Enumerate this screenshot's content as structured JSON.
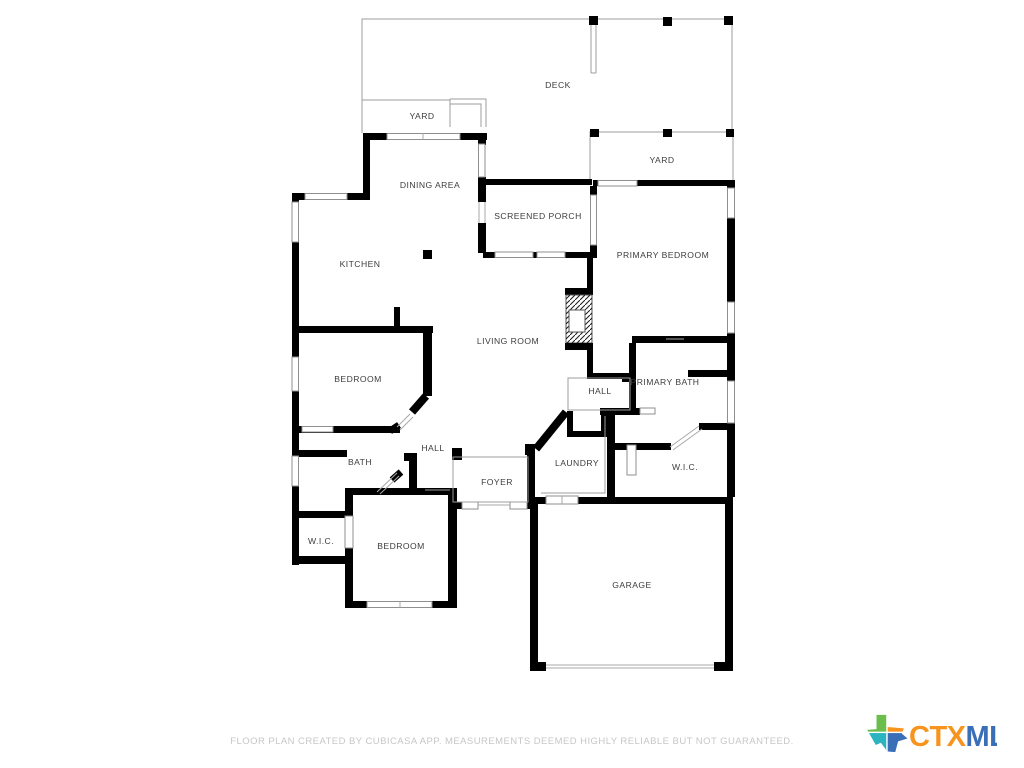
{
  "floor_plan": {
    "rooms": {
      "deck": "DECK",
      "yard_upper": "YARD",
      "yard_lower": "YARD",
      "dining_area": "DINING AREA",
      "screened_porch": "SCREENED PORCH",
      "kitchen": "KITCHEN",
      "primary_bedroom": "PRIMARY BEDROOM",
      "living_room": "LIVING ROOM",
      "hall_upper": "HALL",
      "primary_bath": "PRIMARY BATH",
      "bedroom_left": "BEDROOM",
      "bath": "BATH",
      "hall_center": "HALL",
      "laundry": "LAUNDRY",
      "wic_right": "W.I.C.",
      "foyer": "FOYER",
      "wic_left": "W.I.C.",
      "bedroom_lower": "BEDROOM",
      "garage": "GARAGE"
    },
    "colors": {
      "wall": "#000000",
      "thin_line": "#9d9d9d",
      "label": "#3d3d3d"
    }
  },
  "footer": {
    "disclaimer": "FLOOR PLAN CREATED BY CUBICASA APP. MEASUREMENTS DEEMED HIGHLY RELIABLE BUT NOT GUARANTEED."
  },
  "logo": {
    "ctx": "CTX",
    "mls": "MLS",
    "ctx_color": "#F7941E",
    "mls_color": "#3A6FB7",
    "texas_green": "#6CBE4C",
    "texas_orange": "#F7941E",
    "texas_teal": "#2BB3C0",
    "texas_blue": "#3A6FB7"
  }
}
